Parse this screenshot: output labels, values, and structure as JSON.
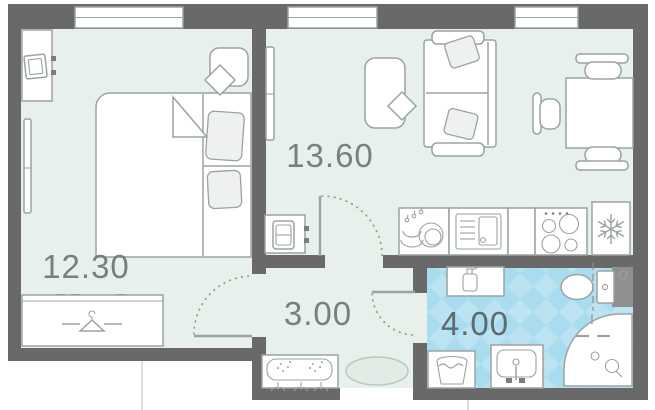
{
  "floorplan": {
    "type": "apartment-floor-plan",
    "rooms": [
      {
        "id": "bedroom",
        "area_label": "12.30",
        "furniture": [
          "bed",
          "wardrobe",
          "dresser",
          "tv-icon",
          "nightstand",
          "radiator"
        ]
      },
      {
        "id": "living-kitchen",
        "area_label": "13.60",
        "furniture": [
          "sofa",
          "coffee-table",
          "dining-table",
          "chairs",
          "tv-stand",
          "radiator",
          "kitchen-sink",
          "dishwasher",
          "stove",
          "fridge"
        ]
      },
      {
        "id": "hallway",
        "area_label": "3.00",
        "furniture": [
          "shoe-bench",
          "coat-hooks",
          "doormat"
        ]
      },
      {
        "id": "bathroom",
        "area_label": "4.00",
        "furniture": [
          "shelf",
          "soap-bottle-icon",
          "toilet",
          "shower",
          "sink",
          "washing-machine"
        ]
      }
    ],
    "windows_count": 3,
    "interior_doors_count": 3,
    "colors": {
      "wall": "#696969",
      "floor": "#e7f0ea",
      "tile_light": "#bbe3f1",
      "tile_dark": "#a8dcee",
      "furniture_stroke": "#9aa3a1",
      "label": "#797f81",
      "bathroom_label": "#5f6a6e"
    }
  }
}
